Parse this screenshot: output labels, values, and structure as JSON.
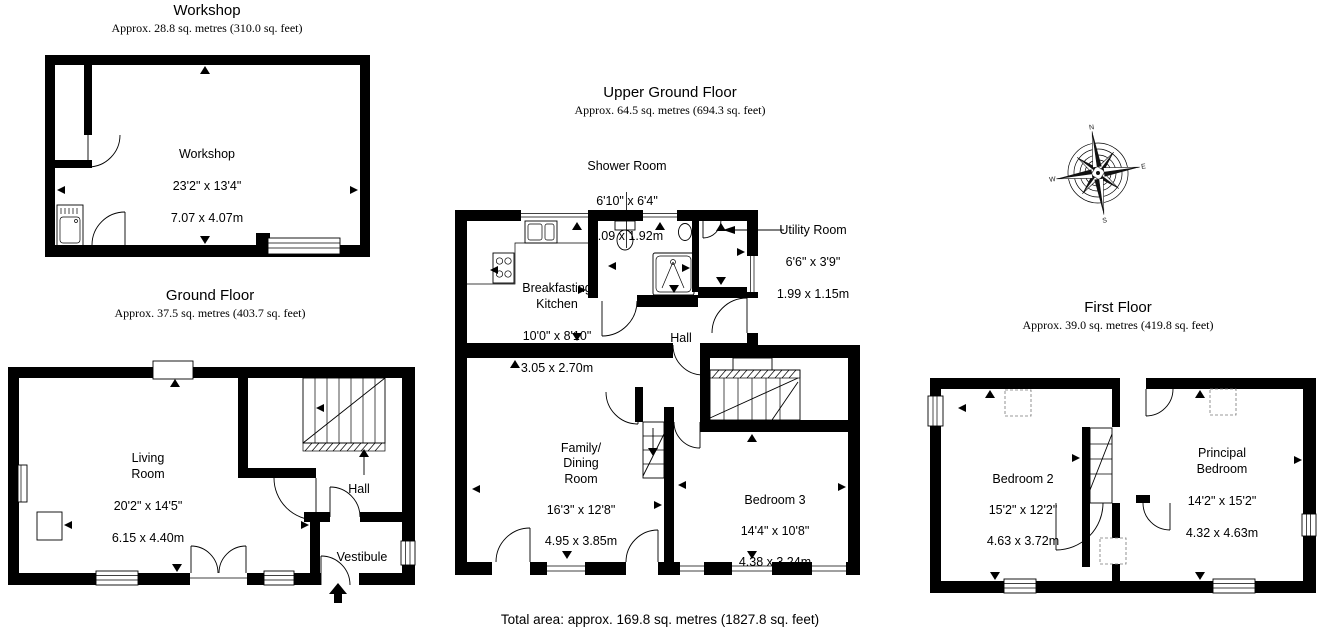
{
  "floors": {
    "workshop": {
      "title": "Workshop",
      "area": "Approx. 28.8 sq. metres (310.0 sq. feet)",
      "rooms": {
        "workshop": {
          "name": "Workshop",
          "imperial": "23'2\" x 13'4\"",
          "metric": "7.07 x 4.07m"
        }
      }
    },
    "ground": {
      "title": "Ground Floor",
      "area": "Approx. 37.5 sq. metres (403.7 sq. feet)",
      "rooms": {
        "living": {
          "name": "Living\nRoom",
          "imperial": "20'2\" x 14'5\"",
          "metric": "6.15 x 4.40m"
        },
        "hall": {
          "name": "Hall"
        },
        "vestibule": {
          "name": "Vestibule"
        }
      }
    },
    "upper": {
      "title": "Upper Ground Floor",
      "area": "Approx. 64.5 sq. metres (694.3 sq. feet)",
      "rooms": {
        "shower": {
          "name": "Shower Room",
          "imperial": "6'10\" x 6'4\"",
          "metric": "2.09 x 1.92m"
        },
        "utility": {
          "name": "Utility Room",
          "imperial": "6'6\" x 3'9\"",
          "metric": "1.99 x 1.15m"
        },
        "kitchen": {
          "name": "Breakfasting\nKitchen",
          "imperial": "10'0\" x 8'10\"",
          "metric": "3.05 x 2.70m"
        },
        "hall": {
          "name": "Hall"
        },
        "family": {
          "name": "Family/\nDining\nRoom",
          "imperial": "16'3\" x 12'8\"",
          "metric": "4.95 x 3.85m"
        },
        "bedroom3": {
          "name": "Bedroom 3",
          "imperial": "14'4\" x 10'8\"",
          "metric": "4.38 x 3.24m"
        }
      }
    },
    "first": {
      "title": "First Floor",
      "area": "Approx. 39.0 sq. metres (419.8 sq. feet)",
      "rooms": {
        "bedroom2": {
          "name": "Bedroom 2",
          "imperial": "15'2\" x 12'2\"",
          "metric": "4.63 x 3.72m"
        },
        "principal": {
          "name": "Principal\nBedroom",
          "imperial": "14'2\" x 15'2\"",
          "metric": "4.32 x 4.63m"
        }
      }
    }
  },
  "compass": {
    "north": "N",
    "east": "E",
    "south": "S",
    "west": "W"
  },
  "footer": {
    "total_area": "Total area: approx. 169.8 sq. metres (1827.8 sq. feet)"
  },
  "colors": {
    "wall": "#000000",
    "background": "#ffffff"
  }
}
